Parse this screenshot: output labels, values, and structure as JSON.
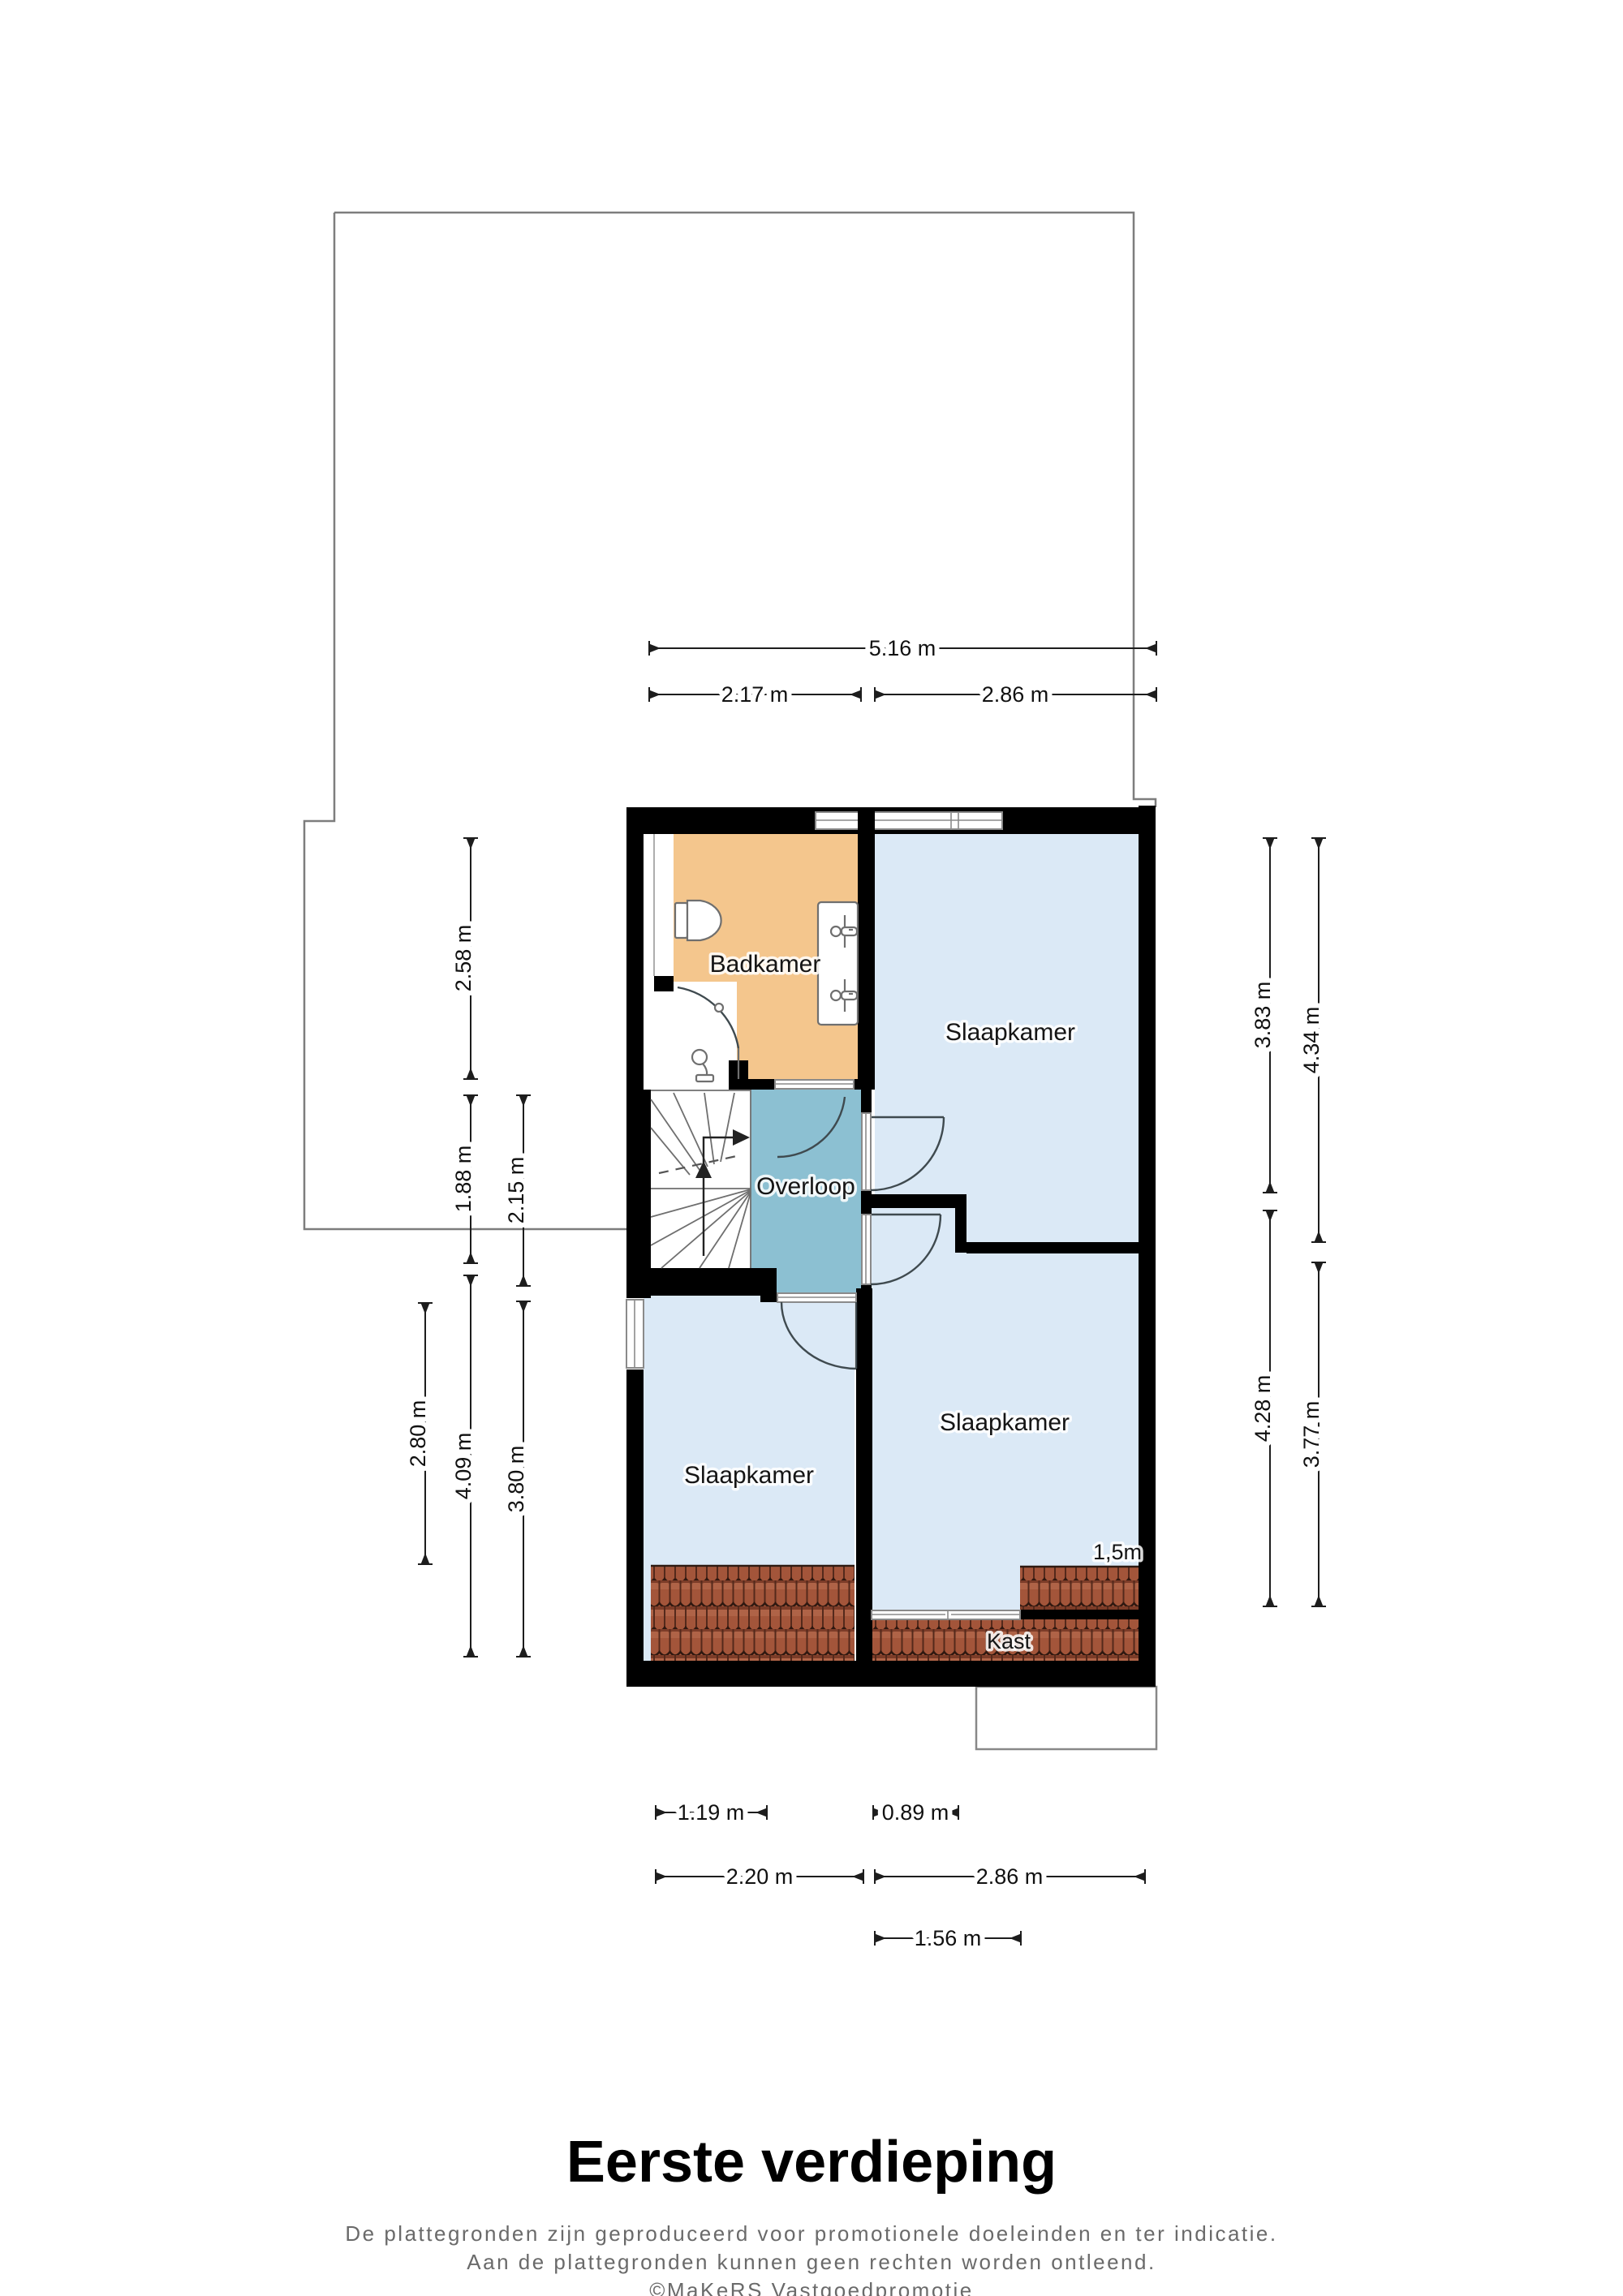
{
  "title": "Eerste verdieping",
  "disclaimer": {
    "line1": "De plattegronden zijn geproduceerd voor promotionele doeleinden en ter indicatie.",
    "line2": "Aan de plattegronden kunnen geen rechten worden ontleend.",
    "line3": "©MaKeRS Vastgoedpromotie"
  },
  "rooms": {
    "badkamer": {
      "label": "Badkamer"
    },
    "slaapkamer_boven": {
      "label": "Slaapkamer"
    },
    "overloop": {
      "label": "Overloop"
    },
    "slaapkamer_links": {
      "label": "Slaapkamer"
    },
    "slaapkamer_rechts": {
      "label": "Slaapkamer"
    },
    "kast": {
      "label": "Kast"
    },
    "hoogtelijn": {
      "label": "1,5m"
    }
  },
  "dimensions": {
    "top": [
      {
        "label": "5.16 m"
      },
      {
        "label": "2.17 m"
      },
      {
        "label": "2.86 m"
      }
    ],
    "left": [
      {
        "label": "2.58 m"
      },
      {
        "label": "1.88 m"
      },
      {
        "label": "4.09 m"
      },
      {
        "label": "2.15 m"
      },
      {
        "label": "3.80 m"
      },
      {
        "label": "2.80 m"
      }
    ],
    "right": [
      {
        "label": "3.83 m"
      },
      {
        "label": "4.28 m"
      },
      {
        "label": "4.34 m"
      },
      {
        "label": "3.77 m"
      }
    ],
    "bottom": [
      {
        "label": "1.19 m"
      },
      {
        "label": "0.89 m"
      },
      {
        "label": "2.20 m"
      },
      {
        "label": "2.86 m"
      },
      {
        "label": "1.56 m"
      }
    ]
  },
  "colors": {
    "room_blue": "#dbe9f6",
    "bathroom_orange": "#f4c68d",
    "landing_teal": "#8cc0d2",
    "wall_black": "#000000",
    "tile_red": "#a3553a",
    "outline_gray": "#7d7d7d"
  }
}
